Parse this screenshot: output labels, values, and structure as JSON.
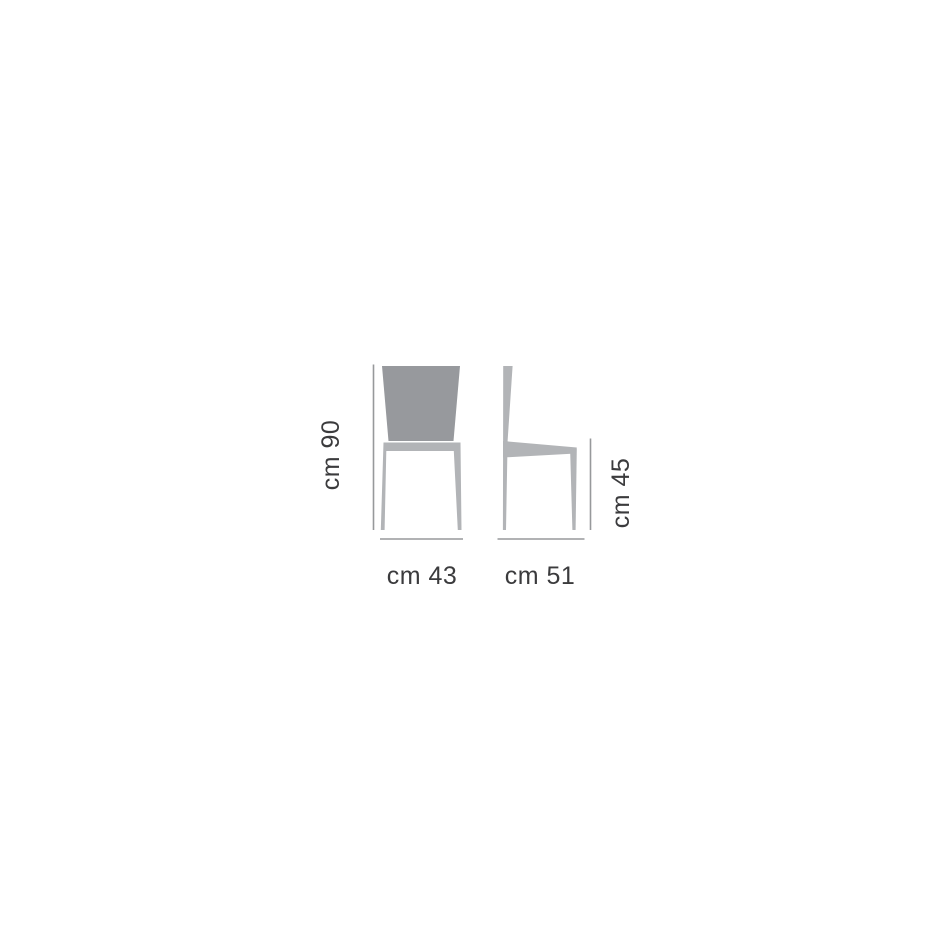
{
  "page": {
    "background": "#ffffff"
  },
  "diagram": {
    "kind": "chair-dimension-drawing",
    "colors": {
      "backrest": "#97999d",
      "frame": "#b2b4b7",
      "dimension_line": "#97999b",
      "text": "#3b3b3d"
    },
    "dimensions": {
      "height": {
        "label": "cm 90",
        "unit": "cm",
        "value": 90
      },
      "width": {
        "label": "cm 43",
        "unit": "cm",
        "value": 43
      },
      "seat_height": {
        "label": "cm 45",
        "unit": "cm",
        "value": 45
      },
      "depth": {
        "label": "cm 51",
        "unit": "cm",
        "value": 51
      }
    }
  }
}
